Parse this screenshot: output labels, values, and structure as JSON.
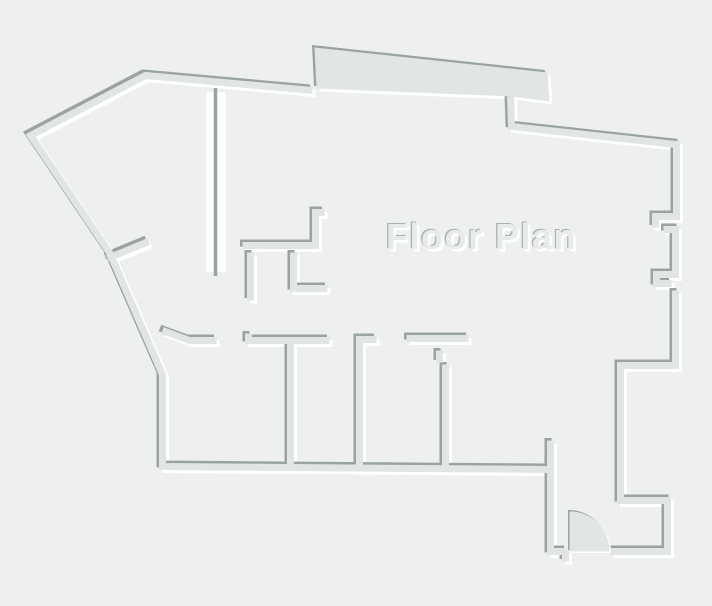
{
  "title": "Floor Plan",
  "canvas": {
    "width": 712,
    "height": 606
  },
  "colors": {
    "background": "#eef0f0",
    "wall_body": "#e1e6e5",
    "wall_shadow": "#9aa3a3",
    "wall_highlight": "#ffffff",
    "title_fill": "#e8ebeb",
    "title_shadow": "#a9b2b2",
    "title_highlight": "#ffffff"
  }
}
